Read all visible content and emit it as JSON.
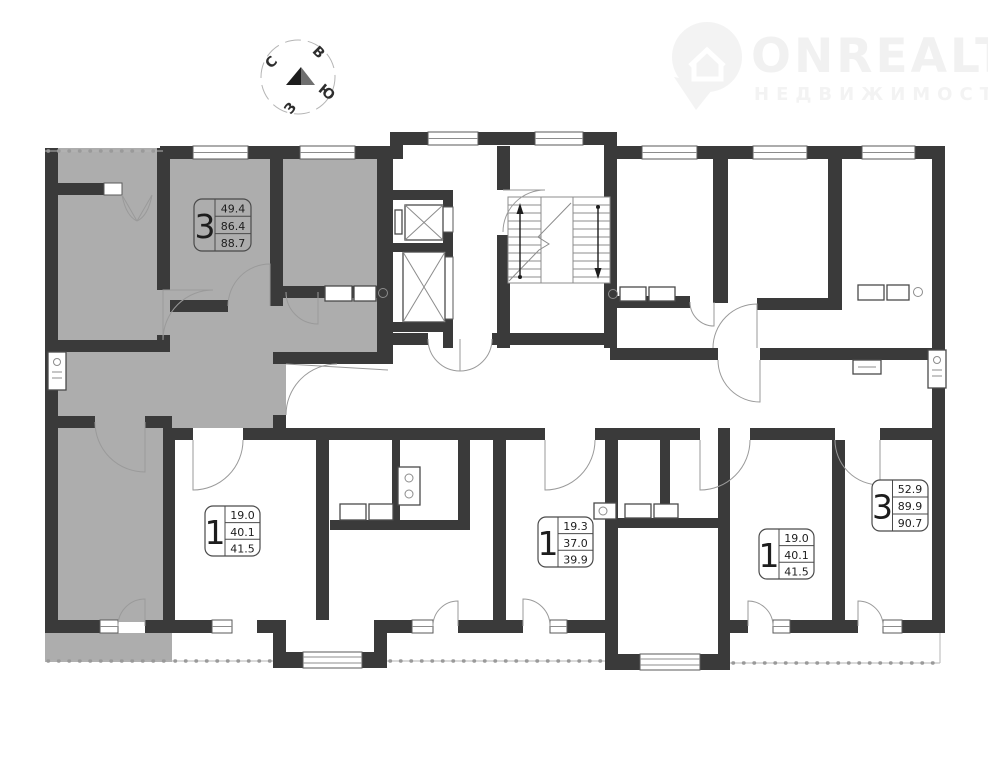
{
  "logo": {
    "brand": "ONREALT",
    "subtitle": "НЕДВИЖИМОСТЬ",
    "color": "#f1f1f1"
  },
  "compass": {
    "north": "С",
    "east": "В",
    "south": "Ю",
    "west": "З"
  },
  "plan": {
    "wall_color": "#3a3a3a",
    "highlight_color": "#adadad",
    "apartments": [
      {
        "rooms": "3",
        "living_area": "49.4",
        "usable_area": "86.4",
        "total_area": "88.7",
        "highlighted": true
      },
      {
        "rooms": "1",
        "living_area": "19.0",
        "usable_area": "40.1",
        "total_area": "41.5",
        "highlighted": false
      },
      {
        "rooms": "1",
        "living_area": "19.3",
        "usable_area": "37.0",
        "total_area": "39.9",
        "highlighted": false
      },
      {
        "rooms": "1",
        "living_area": "19.0",
        "usable_area": "40.1",
        "total_area": "41.5",
        "highlighted": false
      },
      {
        "rooms": "3",
        "living_area": "52.9",
        "usable_area": "89.9",
        "total_area": "90.7",
        "highlighted": false
      }
    ]
  }
}
